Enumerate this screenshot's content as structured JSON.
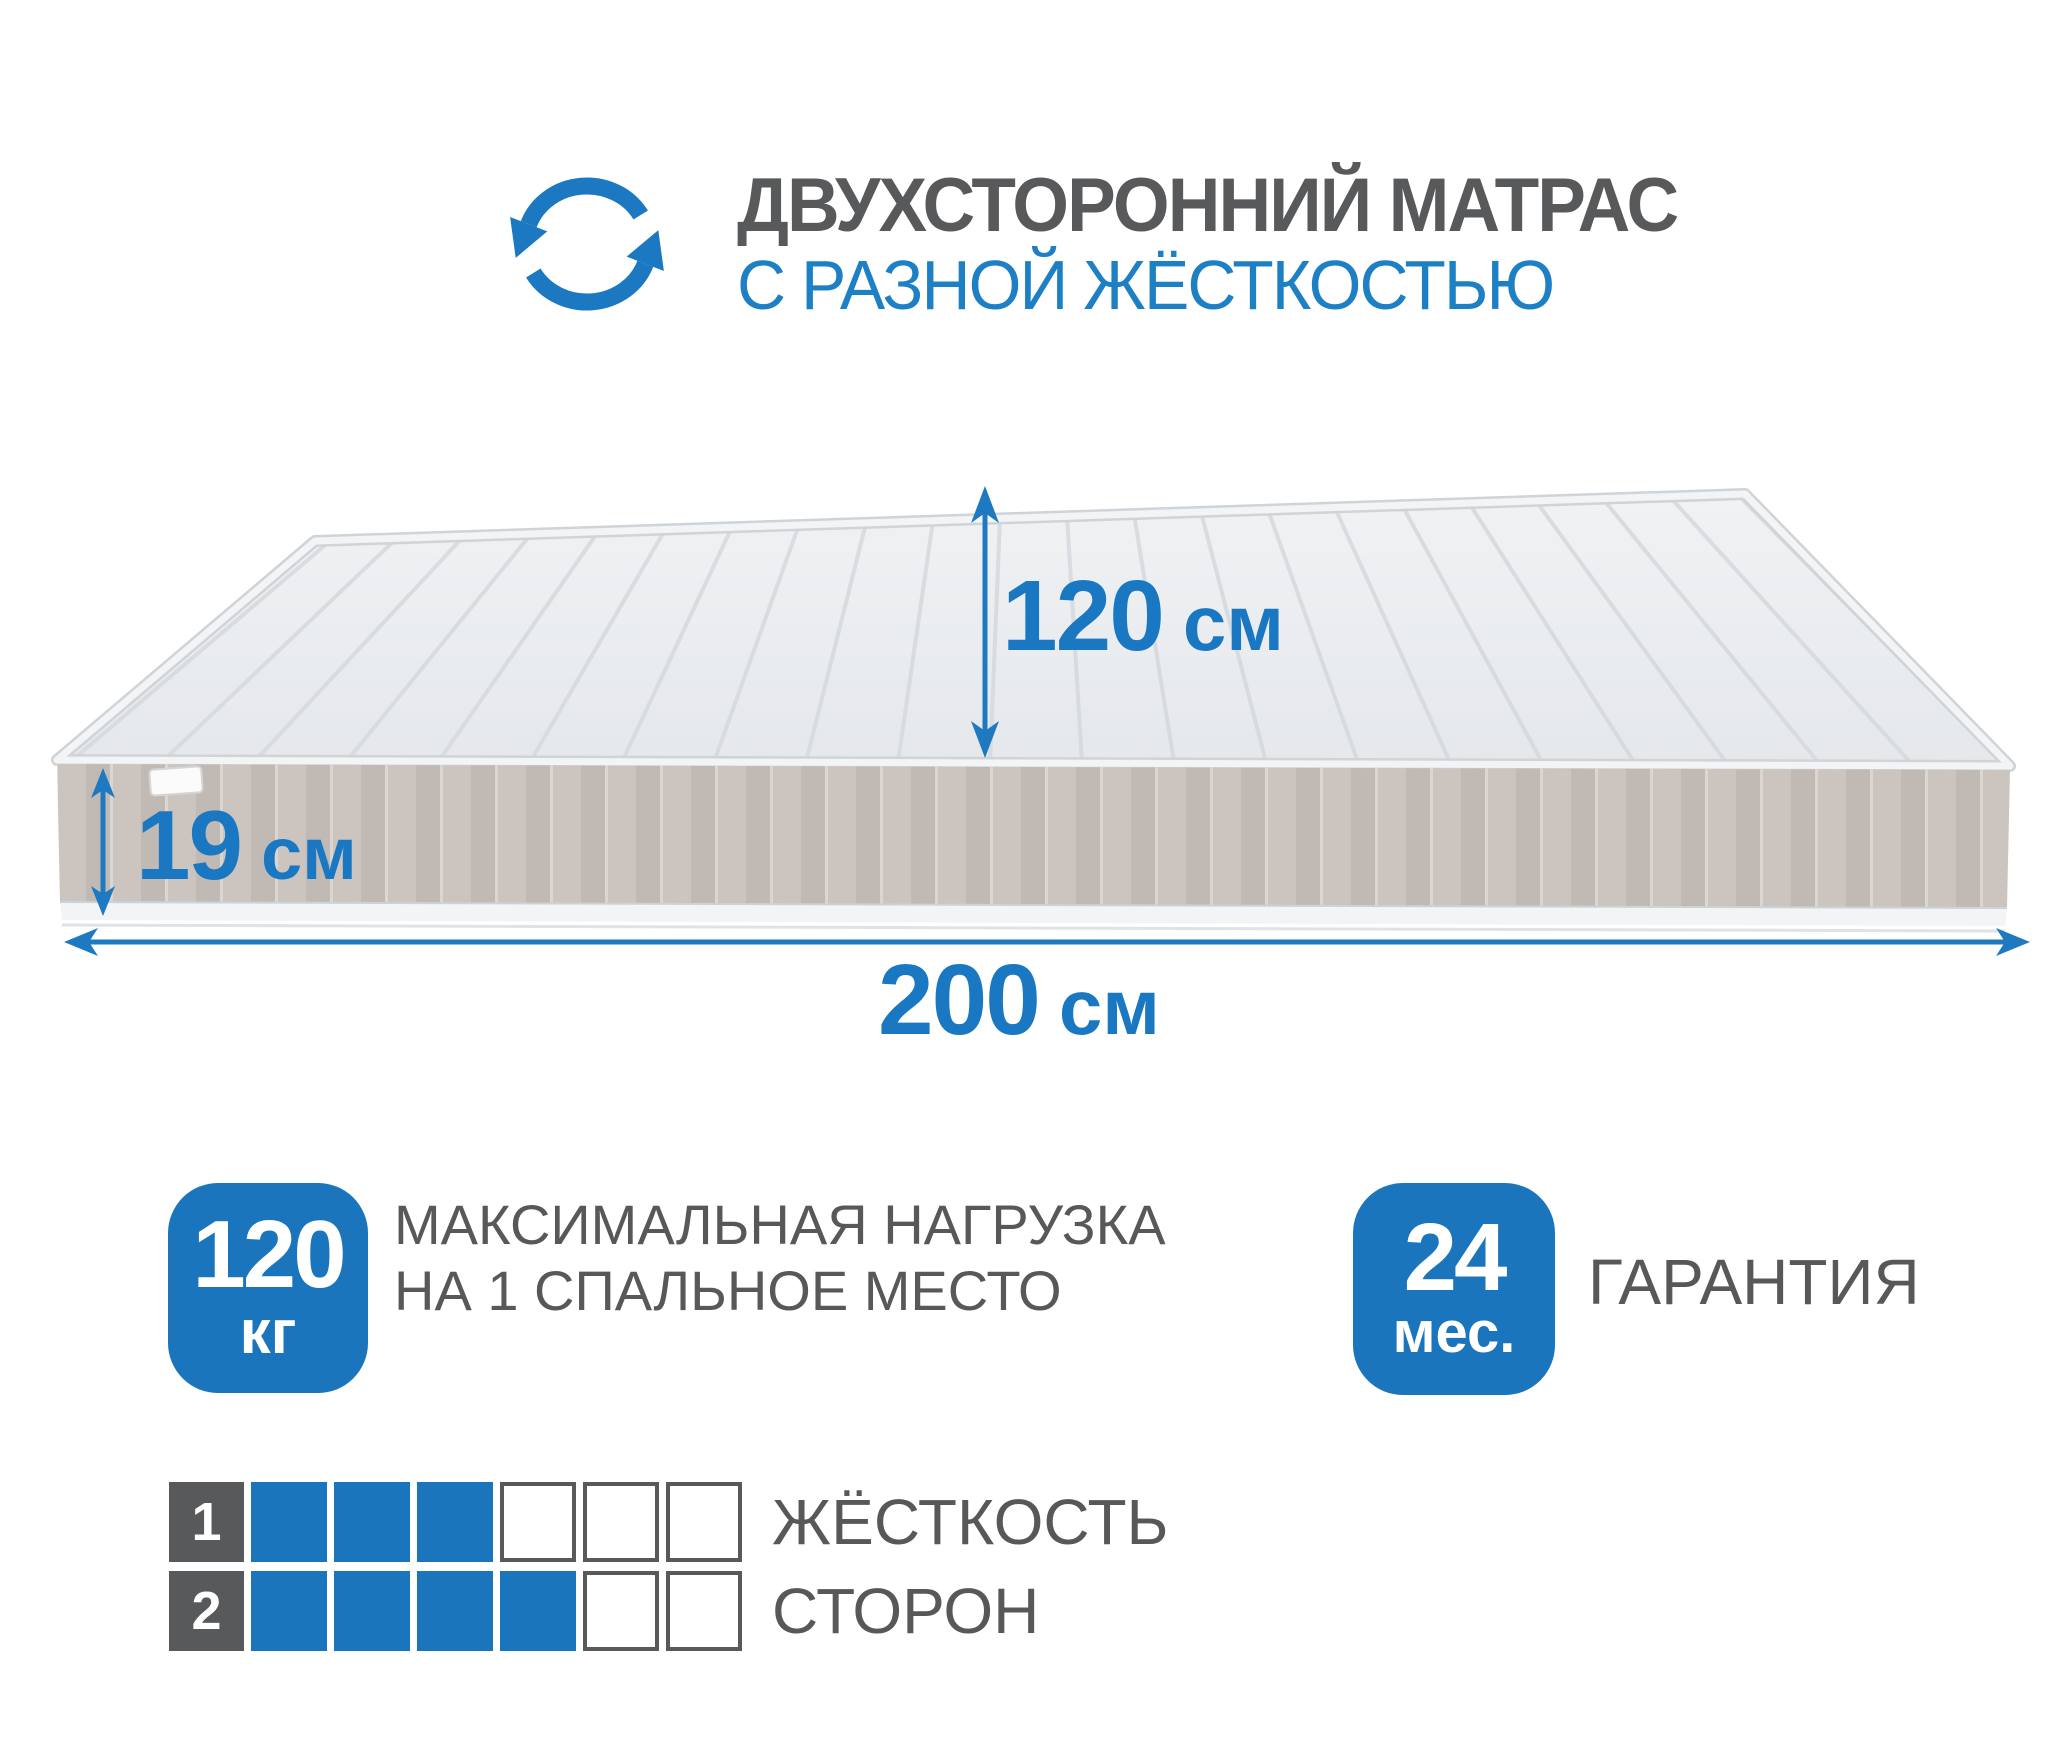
{
  "header": {
    "title_line1": "ДВУХСТОРОННИЙ МАТРАС",
    "title_line2": "С РАЗНОЙ ЖЁСТКОСТЬЮ",
    "icon": "rotate-arrows-icon"
  },
  "mattress": {
    "dimensions": {
      "width": {
        "value": "120",
        "unit": "см"
      },
      "height": {
        "value": "19",
        "unit": "см"
      },
      "length": {
        "value": "200",
        "unit": "см"
      }
    }
  },
  "badges": {
    "max_load": {
      "value": "120",
      "unit": "кг",
      "label_line1": "МАКСИМАЛЬНАЯ НАГРУЗКА",
      "label_line2": "НА 1 СПАЛЬНОЕ МЕСТО"
    },
    "warranty": {
      "value": "24",
      "unit": "мес.",
      "label": "ГАРАНТИЯ"
    }
  },
  "hardness": {
    "label_line1": "ЖЁСТКОСТЬ",
    "label_line2": "СТОРОН",
    "scale_max": 6,
    "sides": [
      {
        "index": "1",
        "filled": 3
      },
      {
        "index": "2",
        "filled": 4
      }
    ]
  },
  "colors": {
    "accent_blue": "#1b78c1",
    "badge_blue": "#1b75bc",
    "title_gray": "#58595b",
    "mattress_top": "#eaedef",
    "mattress_side": "#c7c0ba"
  }
}
